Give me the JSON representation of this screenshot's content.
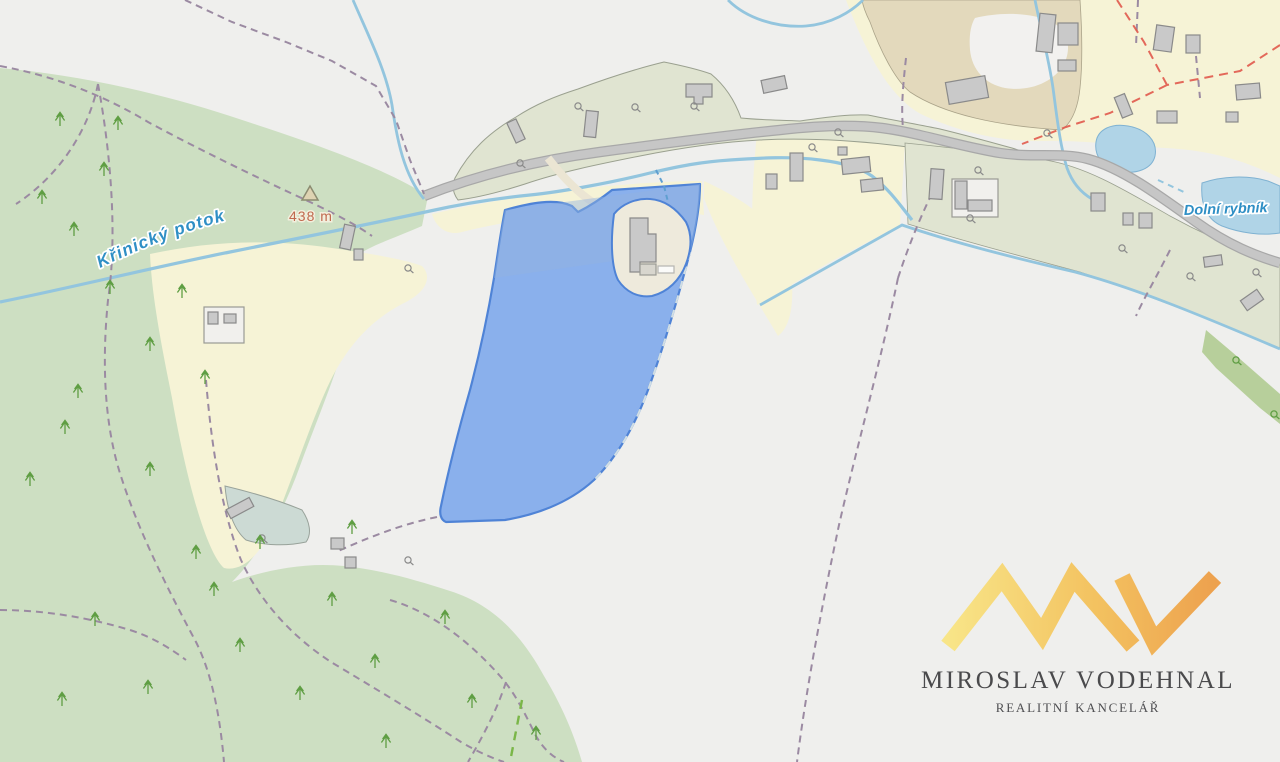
{
  "map": {
    "labels": {
      "stream": "Křinický potok",
      "elevation_point": "438 m",
      "pond": "Dolní rybník"
    },
    "colors": {
      "forest": "#cddfc2",
      "field_cream": "#f6f3d6",
      "settlement": "#e0e4d1",
      "water": "#93c5de",
      "parcel_highlight": "#8ab0ec",
      "parcel_border": "#4f83d6",
      "boundary_dash": "#9b8aa2",
      "municipal_dash_red": "#e15a4d",
      "road": "#c6c6c6"
    }
  },
  "watermark": {
    "monogram": "MV",
    "company": "MIROSLAV VODEHNAL",
    "tagline": "REALITNÍ KANCELÁŘ",
    "accent_yellow": "#f6e386",
    "accent_orange": "#eda14e"
  }
}
